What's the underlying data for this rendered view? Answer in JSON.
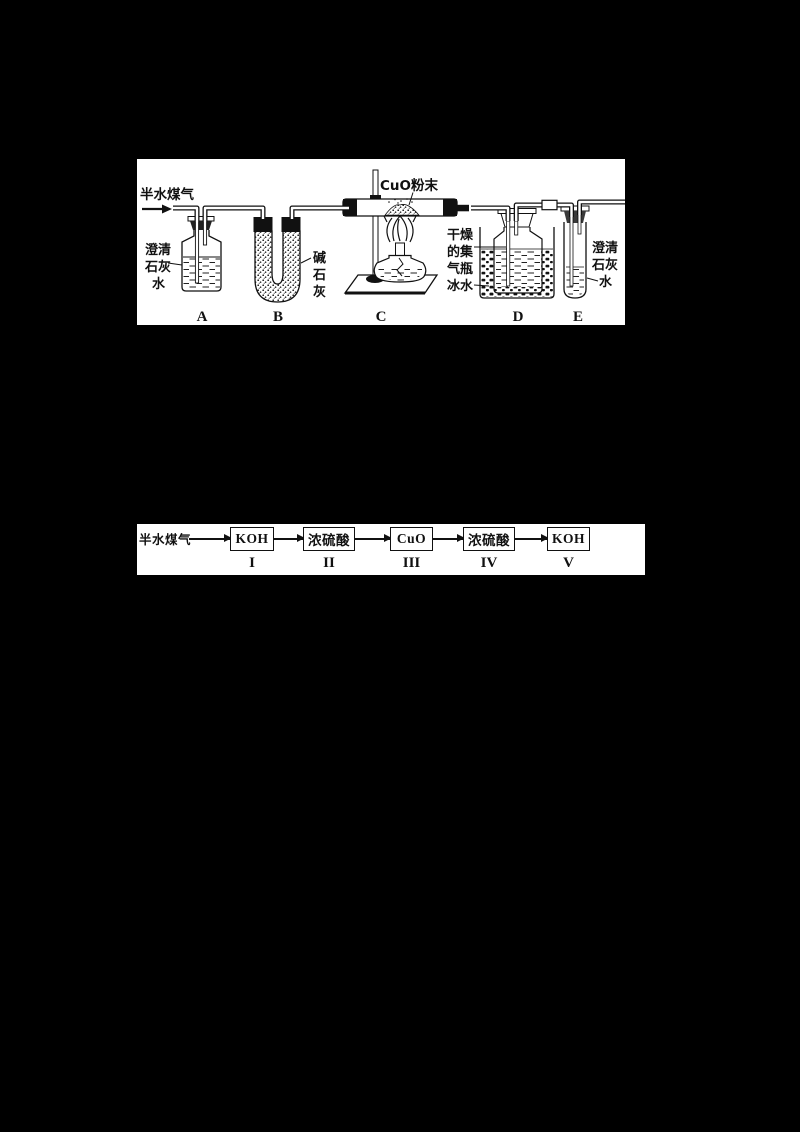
{
  "colors": {
    "background": "#000000",
    "panel": "#ffffff",
    "ink": "#111111"
  },
  "apparatus": {
    "inlet_label": "半水煤气",
    "vessels": [
      {
        "letter": "A",
        "label_lines": [
          "澄清",
          "石灰",
          "水"
        ]
      },
      {
        "letter": "B",
        "label_lines": [
          "碱",
          "石",
          "灰"
        ]
      },
      {
        "letter": "C",
        "label": "CuO粉末"
      },
      {
        "letter": "D",
        "label_lines": [
          "干燥",
          "的集",
          "气瓶",
          "冰水"
        ]
      },
      {
        "letter": "E",
        "label_lines": [
          "澄清",
          "石灰",
          "水"
        ]
      }
    ]
  },
  "flow": {
    "input_label": "半水煤气",
    "steps": [
      {
        "reagent": "KOH",
        "numeral": "I"
      },
      {
        "reagent": "浓硫酸",
        "numeral": "II"
      },
      {
        "reagent": "CuO",
        "numeral": "III"
      },
      {
        "reagent": "浓硫酸",
        "numeral": "IV"
      },
      {
        "reagent": "KOH",
        "numeral": "V"
      }
    ]
  }
}
